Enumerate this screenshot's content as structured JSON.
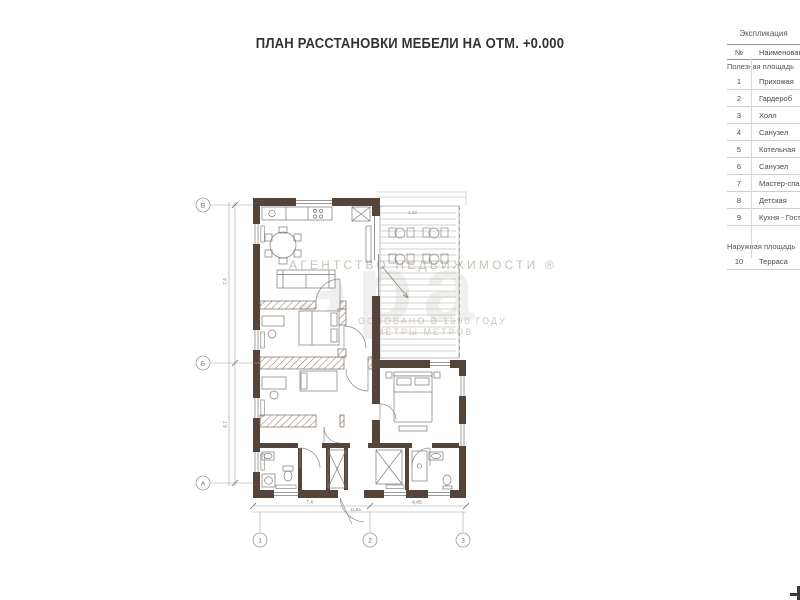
{
  "title": "ПЛАН РАССТАНОВКИ МЕБЕЛИ НА ОТМ. +0.000",
  "watermark": {
    "agency_line": "АГЕНТСТВО  НЕДВИЖИМОСТИ ®",
    "logo_text": "эра",
    "sub_line1": "ОСНОВАНО В 1990 ГОДУ",
    "sub_line2": "МЕТРЫ МЕТРОВ"
  },
  "explication": {
    "title": "Экспликация",
    "columns": {
      "num": "№",
      "name": "Наименование"
    },
    "sections": [
      {
        "header": "Полезная площадь",
        "gap_after": true,
        "rows": [
          [
            "1",
            "Прихожая"
          ],
          [
            "2",
            "Гардероб"
          ],
          [
            "3",
            "Холл"
          ],
          [
            "4",
            "Санузел"
          ],
          [
            "5",
            "Котельная"
          ],
          [
            "6",
            "Санузел"
          ],
          [
            "7",
            "Мастер-спальня"
          ],
          [
            "8",
            "Детская"
          ],
          [
            "9",
            "Кухня - Гостиная"
          ]
        ]
      },
      {
        "header": "Наружная площадь",
        "gap_after": false,
        "rows": [
          [
            "10",
            "Терраса"
          ]
        ]
      }
    ]
  },
  "axes": {
    "left": [
      "В",
      "Б",
      "А"
    ],
    "bottom": [
      "1",
      "2",
      "3"
    ]
  },
  "dims": {
    "left_top": "7,4",
    "left_bottom": "4,7",
    "bottom_left": "7,4",
    "bottom_right": "4,45",
    "bottom_total": "11,85",
    "terrace_mark": "1.10"
  },
  "colors": {
    "wall": "#54443a",
    "hatch": "#8f7c66",
    "dim": "#909090",
    "watermark": "#c9c3b8"
  }
}
